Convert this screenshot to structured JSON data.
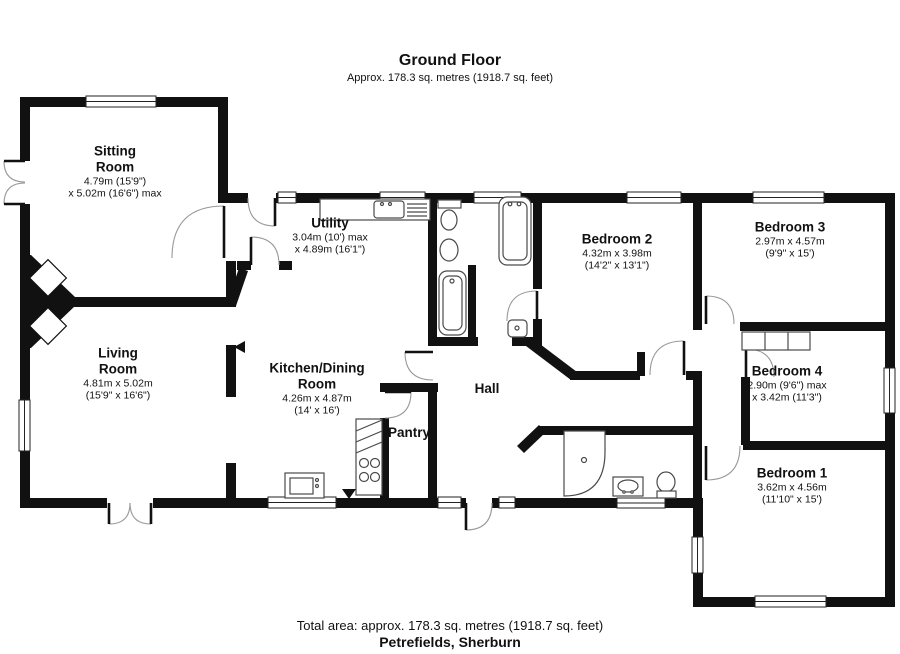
{
  "header": {
    "title": "Ground Floor",
    "subtitle": "Approx. 178.3 sq. metres (1918.7 sq. feet)"
  },
  "footer": {
    "total_area": "Total area: approx. 178.3 sq. metres (1918.7 sq. feet)",
    "property_name": "Petrefields, Sherburn"
  },
  "colors": {
    "wall": "#111111",
    "background": "#ffffff",
    "fixture_outline": "#4a4a4a",
    "door_arc": "#888888"
  },
  "rooms": [
    {
      "id": "sitting-room",
      "name": "Sitting Room",
      "dim1": "4.79m (15'9\")",
      "dim2": "x 5.02m (16'6\") max"
    },
    {
      "id": "utility",
      "name": "Utility",
      "dim1": "3.04m (10') max",
      "dim2": "x 4.89m (16'1\")"
    },
    {
      "id": "bedroom-2",
      "name": "Bedroom 2",
      "dim1": "4.32m x 3.98m",
      "dim2": "(14'2\" x 13'1\")"
    },
    {
      "id": "bedroom-3",
      "name": "Bedroom 3",
      "dim1": "2.97m x 4.57m",
      "dim2": "(9'9\" x 15')"
    },
    {
      "id": "living-room",
      "name": "Living Room",
      "dim1": "4.81m x 5.02m",
      "dim2": "(15'9\" x 16'6\")"
    },
    {
      "id": "kitchen-dining",
      "name": "Kitchen/Dining Room",
      "dim1": "4.26m x 4.87m",
      "dim2": "(14' x 16')"
    },
    {
      "id": "hall",
      "name": "Hall",
      "dim1": "",
      "dim2": ""
    },
    {
      "id": "pantry",
      "name": "Pantry",
      "dim1": "",
      "dim2": ""
    },
    {
      "id": "bedroom-4",
      "name": "Bedroom 4",
      "dim1": "2.90m (9'6\") max",
      "dim2": "x 3.42m (11'3\")"
    },
    {
      "id": "bedroom-1",
      "name": "Bedroom 1",
      "dim1": "3.62m x 4.56m",
      "dim2": "(11'10\" x 15')"
    }
  ]
}
